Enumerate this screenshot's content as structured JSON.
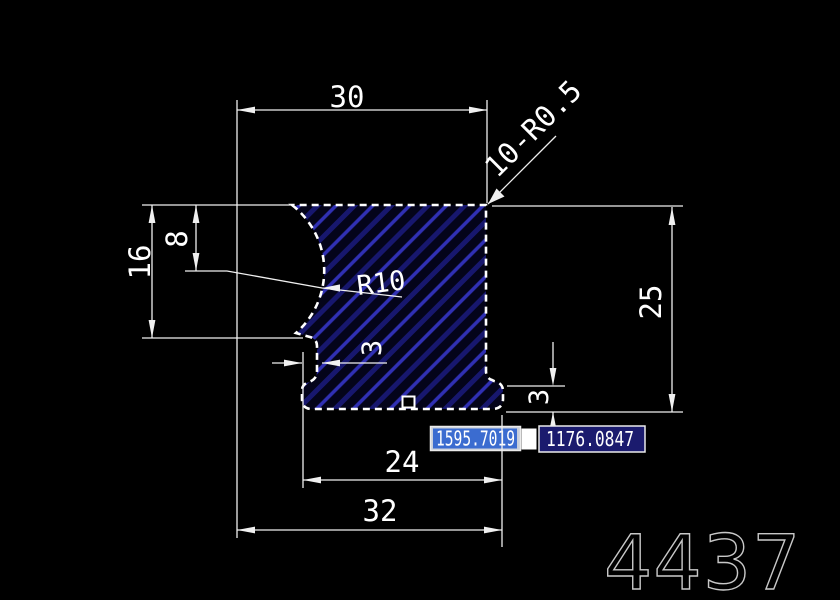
{
  "drawing": {
    "dim_top_width": "30",
    "dim_corner_note": "10-R0.5",
    "dim_left_total": "16",
    "dim_left_upper": "8",
    "dim_arc_radius": "R10",
    "dim_right_height": "25",
    "dim_left_wall": "3",
    "dim_bottom_lip": "3",
    "dim_bottom_inner": "24",
    "dim_bottom_total": "32"
  },
  "coordinate_input": {
    "x_field": "1595.7019",
    "y_field": "1176.0847"
  },
  "watermark": "4437",
  "colors": {
    "background": "#000000",
    "outline": "#ffffff",
    "dimension": "#f0f0f0",
    "hatch_fill": "#04041a",
    "hatch_dark": "#17176e",
    "hatch_bright": "#3030b4",
    "x_field_bg": "#c8ceda",
    "x_field_selection": "#3b6cd0",
    "x_field_text": "#ffffff",
    "y_field_bg": "#1b1b6e",
    "y_field_text": "#d8d8f0",
    "field_border": "#ebebeb",
    "cursor_block": "#ffffff",
    "watermark_color": "#c8c8c8"
  }
}
